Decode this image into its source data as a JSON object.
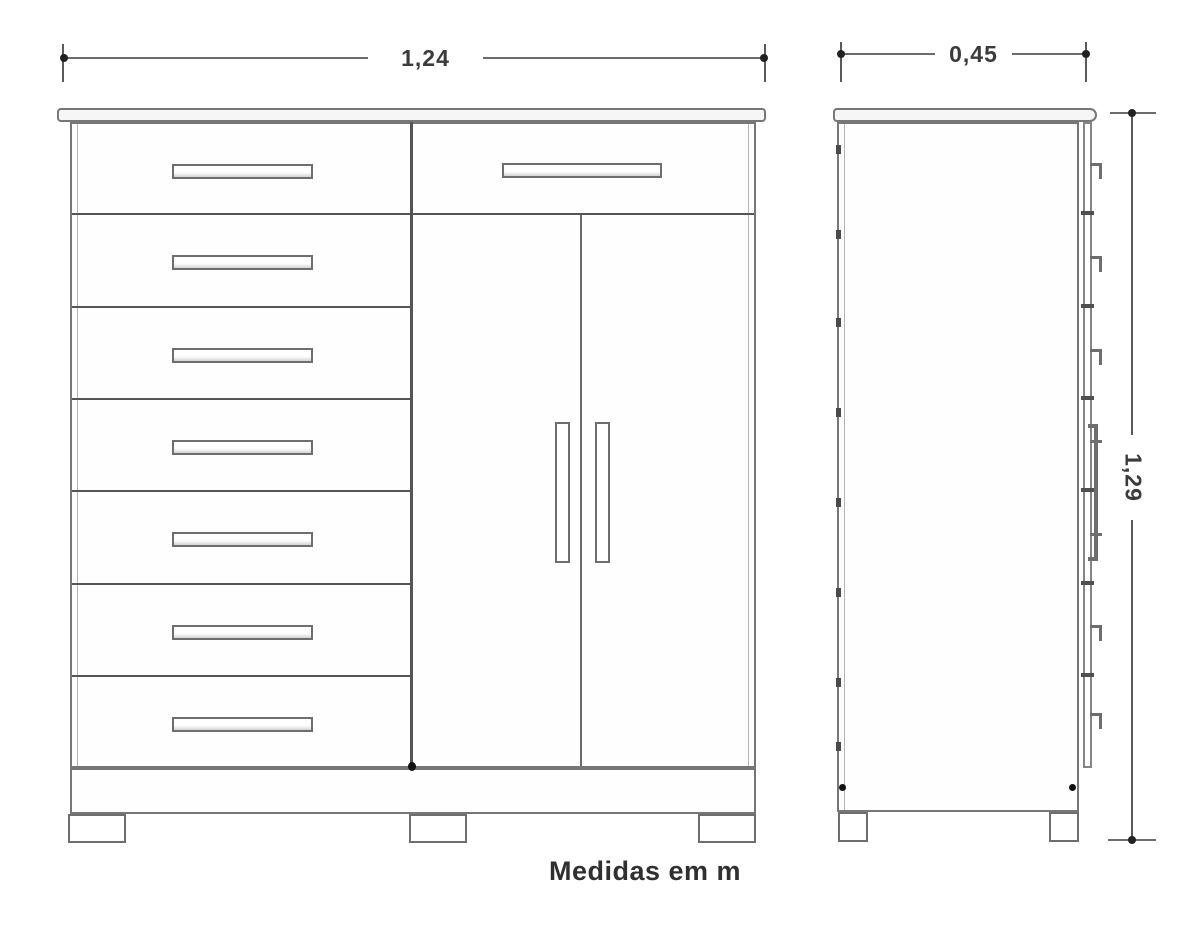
{
  "caption": "Medidas em m",
  "dimensions": {
    "front_width_m": "1,24",
    "side_depth_m": "0,45",
    "height_m": "1,29"
  },
  "views": {
    "front": {
      "name": "front-elevation",
      "left_column_drawer_count": 7,
      "right_column_top_drawer_count": 1,
      "door_count": 2,
      "feet_count": 3
    },
    "side": {
      "name": "side-elevation",
      "feet_count": 2
    }
  },
  "units_note": "measurements in meters",
  "colors": {
    "background": "#ffffff",
    "drawing_line": "#777777",
    "divider_line": "#555555",
    "dimension_text": "#3b3b3b",
    "caption_text": "#303030"
  }
}
